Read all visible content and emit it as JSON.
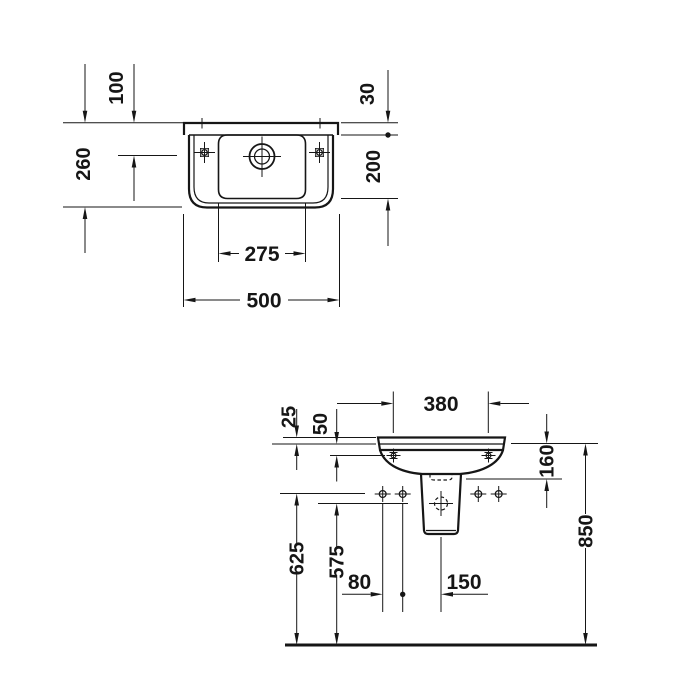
{
  "drawing": {
    "background_color": "#ffffff",
    "line_color": "#161616",
    "plan_view": {
      "dim_labels": {
        "d100": "100",
        "d260": "260",
        "d30": "30",
        "d200": "200",
        "d275": "275",
        "d500": "500"
      }
    },
    "elevation_view": {
      "dim_labels": {
        "d25": "25",
        "d50": "50",
        "d380": "380",
        "d160": "160",
        "d625": "625",
        "d575": "575",
        "d80": "80",
        "d150": "150",
        "d850": "850"
      }
    }
  }
}
